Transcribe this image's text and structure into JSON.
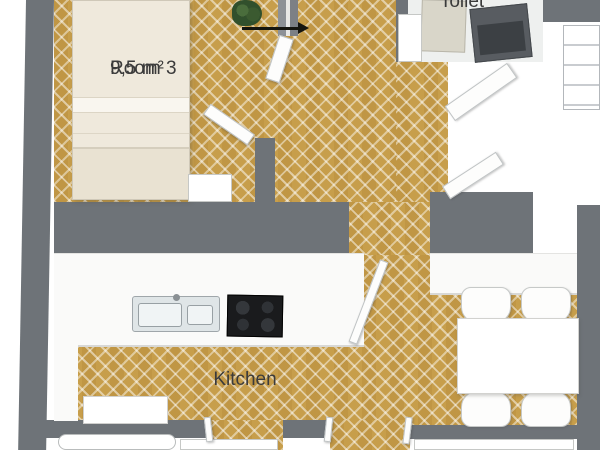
{
  "rooms": {
    "room3": {
      "label": "Room 3",
      "area": "9,5 m²"
    },
    "toilet": {
      "label": "Toilet"
    },
    "kitchen": {
      "label": "Kitchen"
    }
  },
  "colors": {
    "bg": "#ffffff",
    "wall": "#6e7378",
    "wood": "#c79e4b",
    "toiletFloor": "#eef0ef",
    "bed": "#efe9dc",
    "furn": "#ffffff",
    "furnBorder": "#c6c8c6",
    "stove": "#1a1b1d",
    "appliance": "#585c61",
    "plant": "#31502c",
    "label": "#3b3b3b"
  },
  "furniture": [
    "bed",
    "dresser",
    "plant",
    "entrance-door",
    "toilet-door",
    "washing-machine",
    "toilet-fixture",
    "wardrobe",
    "kitchen-counter",
    "kitchen-sink",
    "stove",
    "kitchen-window",
    "sideboard",
    "dining-table",
    "dining-chair"
  ]
}
